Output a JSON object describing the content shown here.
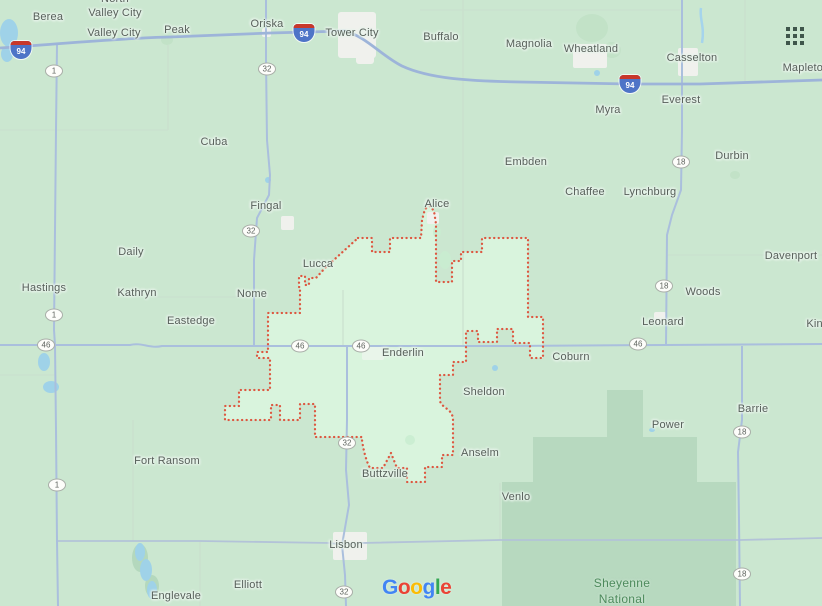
{
  "page": {
    "width": 822,
    "height": 606,
    "app": "google-maps-embed"
  },
  "branding": {
    "logo_text": "Google",
    "logo_letters": [
      {
        "ch": "G",
        "color": "#4285F4"
      },
      {
        "ch": "o",
        "color": "#EA4335"
      },
      {
        "ch": "o",
        "color": "#FBBC05"
      },
      {
        "ch": "g",
        "color": "#4285F4"
      },
      {
        "ch": "l",
        "color": "#34A853"
      },
      {
        "ch": "e",
        "color": "#EA4335"
      }
    ]
  },
  "labels": {
    "towns": [
      {
        "name": "Berea",
        "x": 48,
        "y": 17
      },
      {
        "name": "North Valley City",
        "lines": [
          "North",
          "Valley City"
        ],
        "x": 115,
        "y": 6
      },
      {
        "name": "Valley City",
        "x": 114,
        "y": 33
      },
      {
        "name": "Peak",
        "x": 177,
        "y": 30
      },
      {
        "name": "Oriska",
        "x": 267,
        "y": 24
      },
      {
        "name": "Tower City",
        "x": 352,
        "y": 33
      },
      {
        "name": "Buffalo",
        "x": 441,
        "y": 37
      },
      {
        "name": "Magnolia",
        "x": 529,
        "y": 44
      },
      {
        "name": "Wheatland",
        "x": 591,
        "y": 49
      },
      {
        "name": "Casselton",
        "x": 692,
        "y": 58
      },
      {
        "name": "Mapleton",
        "x": 806,
        "y": 68
      },
      {
        "name": "Myra",
        "x": 608,
        "y": 110
      },
      {
        "name": "Everest",
        "x": 681,
        "y": 100
      },
      {
        "name": "Cuba",
        "x": 214,
        "y": 142
      },
      {
        "name": "Embden",
        "x": 526,
        "y": 162
      },
      {
        "name": "Durbin",
        "x": 732,
        "y": 156
      },
      {
        "name": "Chaffee",
        "x": 585,
        "y": 192
      },
      {
        "name": "Lynchburg",
        "x": 650,
        "y": 192
      },
      {
        "name": "Fingal",
        "x": 266,
        "y": 206
      },
      {
        "name": "Alice",
        "x": 437,
        "y": 204
      },
      {
        "name": "Daily",
        "x": 131,
        "y": 252
      },
      {
        "name": "Davenport",
        "x": 791,
        "y": 256
      },
      {
        "name": "Lucca",
        "x": 318,
        "y": 264
      },
      {
        "name": "Hastings",
        "x": 44,
        "y": 288
      },
      {
        "name": "Kathryn",
        "x": 137,
        "y": 293
      },
      {
        "name": "Nome",
        "x": 252,
        "y": 294
      },
      {
        "name": "Woods",
        "x": 703,
        "y": 292
      },
      {
        "name": "Eastedge",
        "x": 191,
        "y": 321
      },
      {
        "name": "Leonard",
        "x": 663,
        "y": 322
      },
      {
        "name": "Kindred",
        "x": 826,
        "y": 324
      },
      {
        "name": "Enderlin",
        "x": 403,
        "y": 353
      },
      {
        "name": "Coburn",
        "x": 571,
        "y": 357
      },
      {
        "name": "Sheldon",
        "x": 484,
        "y": 392
      },
      {
        "name": "Barrie",
        "x": 753,
        "y": 409
      },
      {
        "name": "Power",
        "x": 668,
        "y": 425
      },
      {
        "name": "Fort Ransom",
        "x": 167,
        "y": 461
      },
      {
        "name": "Anselm",
        "x": 480,
        "y": 453
      },
      {
        "name": "Buttzville",
        "x": 385,
        "y": 474
      },
      {
        "name": "Venlo",
        "x": 516,
        "y": 497
      },
      {
        "name": "Lisbon",
        "x": 346,
        "y": 545
      },
      {
        "name": "Elliott",
        "x": 248,
        "y": 585
      },
      {
        "name": "Englevale",
        "x": 176,
        "y": 596
      }
    ],
    "areas": [
      {
        "name": "Sheyenne National",
        "lines": [
          "Sheyenne",
          "National"
        ],
        "x": 622,
        "y": 591
      }
    ]
  },
  "shields": {
    "interstate": [
      {
        "label": "94",
        "x": 21,
        "y": 50
      },
      {
        "label": "94",
        "x": 304,
        "y": 33
      },
      {
        "label": "94",
        "x": 630,
        "y": 84
      }
    ],
    "state": [
      {
        "label": "1",
        "x": 54,
        "y": 71
      },
      {
        "label": "1",
        "x": 54,
        "y": 315
      },
      {
        "label": "1",
        "x": 57,
        "y": 485
      },
      {
        "label": "32",
        "x": 267,
        "y": 69
      },
      {
        "label": "32",
        "x": 251,
        "y": 231
      },
      {
        "label": "32",
        "x": 347,
        "y": 443
      },
      {
        "label": "32",
        "x": 344,
        "y": 592
      },
      {
        "label": "46",
        "x": 46,
        "y": 345
      },
      {
        "label": "46",
        "x": 300,
        "y": 346
      },
      {
        "label": "46",
        "x": 361,
        "y": 346
      },
      {
        "label": "46",
        "x": 638,
        "y": 344
      },
      {
        "label": "18",
        "x": 681,
        "y": 162
      },
      {
        "label": "18",
        "x": 664,
        "y": 286
      },
      {
        "label": "18",
        "x": 742,
        "y": 432
      },
      {
        "label": "18",
        "x": 742,
        "y": 574
      }
    ]
  },
  "colors": {
    "land": "#cbe7d0",
    "district_fill": "#d9f4dd",
    "grassland": "#b7d9bf",
    "water": "#9fd2e8",
    "road_major": "#aabfdd",
    "road_interstate": "#9db4d9",
    "road_minor": "#c9dfce",
    "urban": "#f0f1ed",
    "boundary": "#dd5740",
    "label_text": "#57605a",
    "area_text": "#4d8a5c"
  }
}
